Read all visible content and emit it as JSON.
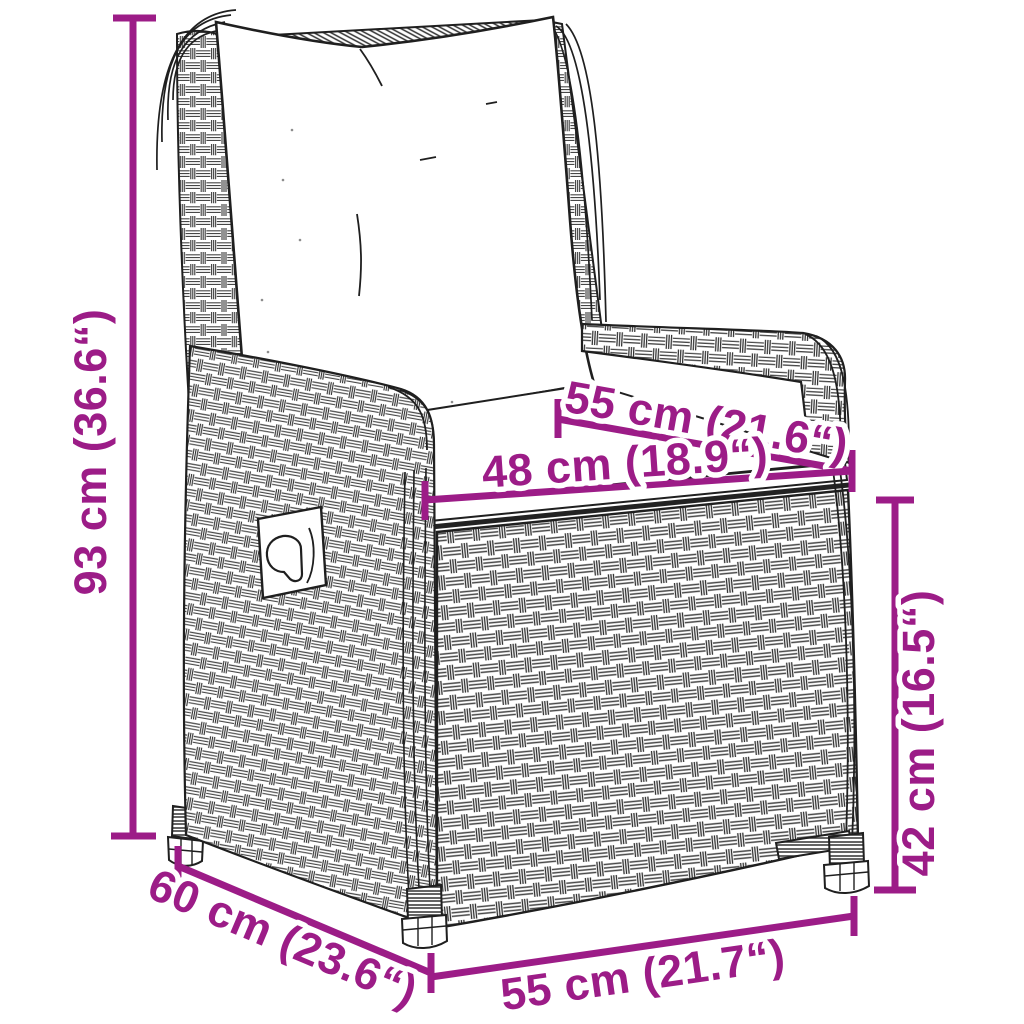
{
  "figure": {
    "type": "product-dimension-diagram",
    "subject": "reclining poly-rattan garden armchair with white cushions (line art)",
    "background_color": "#ffffff",
    "line_art_color": "#1f1f1f",
    "dimension_color": "#9C1C87"
  },
  "dimensions": {
    "overall_height": {
      "label": "93 cm (36.6“)",
      "cm": 93,
      "inches": 36.6
    },
    "seat_depth": {
      "label": "55 cm (21.6“)",
      "cm": 55,
      "inches": 21.6
    },
    "seat_width": {
      "label": "48 cm (18.9“)",
      "cm": 48,
      "inches": 18.9
    },
    "seat_height": {
      "label": "42 cm (16.5“)",
      "cm": 42,
      "inches": 16.5
    },
    "overall_depth": {
      "label": "60 cm (23.6“)",
      "cm": 60,
      "inches": 23.6
    },
    "overall_width": {
      "label": "55 cm (21.7“)",
      "cm": 55,
      "inches": 21.7
    }
  }
}
